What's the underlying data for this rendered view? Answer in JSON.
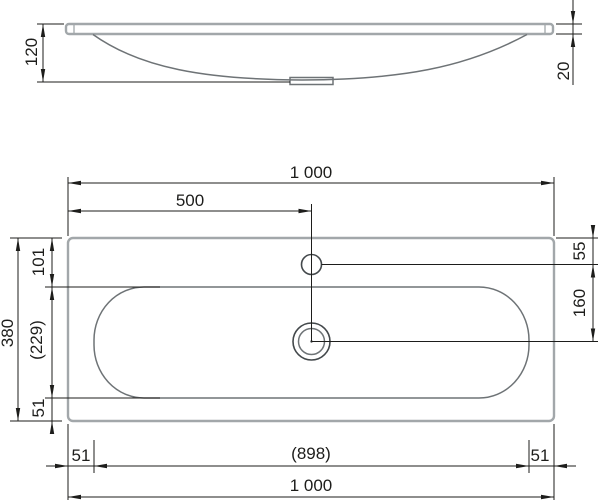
{
  "drawing": {
    "type": "washbasin-technical-drawing",
    "side_view": {
      "total_height": "120",
      "rim_thickness": "20"
    },
    "plan_view": {
      "top": {
        "total_width": "1 000",
        "faucet_center_offset": "500"
      },
      "left": {
        "total_depth": "380",
        "edge_to_bowl": "101",
        "bowl_depth": "(229)",
        "bowl_to_edge": "51"
      },
      "right": {
        "edge_to_faucet": "55",
        "faucet_to_drain": "160"
      },
      "bottom": {
        "left_margin": "51",
        "bowl_width": "(898)",
        "right_margin": "51",
        "total_width": "1 000"
      }
    },
    "colors": {
      "background": "#ffffff",
      "object_outline": "#a2a7aa",
      "object_detail": "#6e7376",
      "fitting_outline": "#43484b",
      "dimension": "#1d1d1b"
    }
  }
}
